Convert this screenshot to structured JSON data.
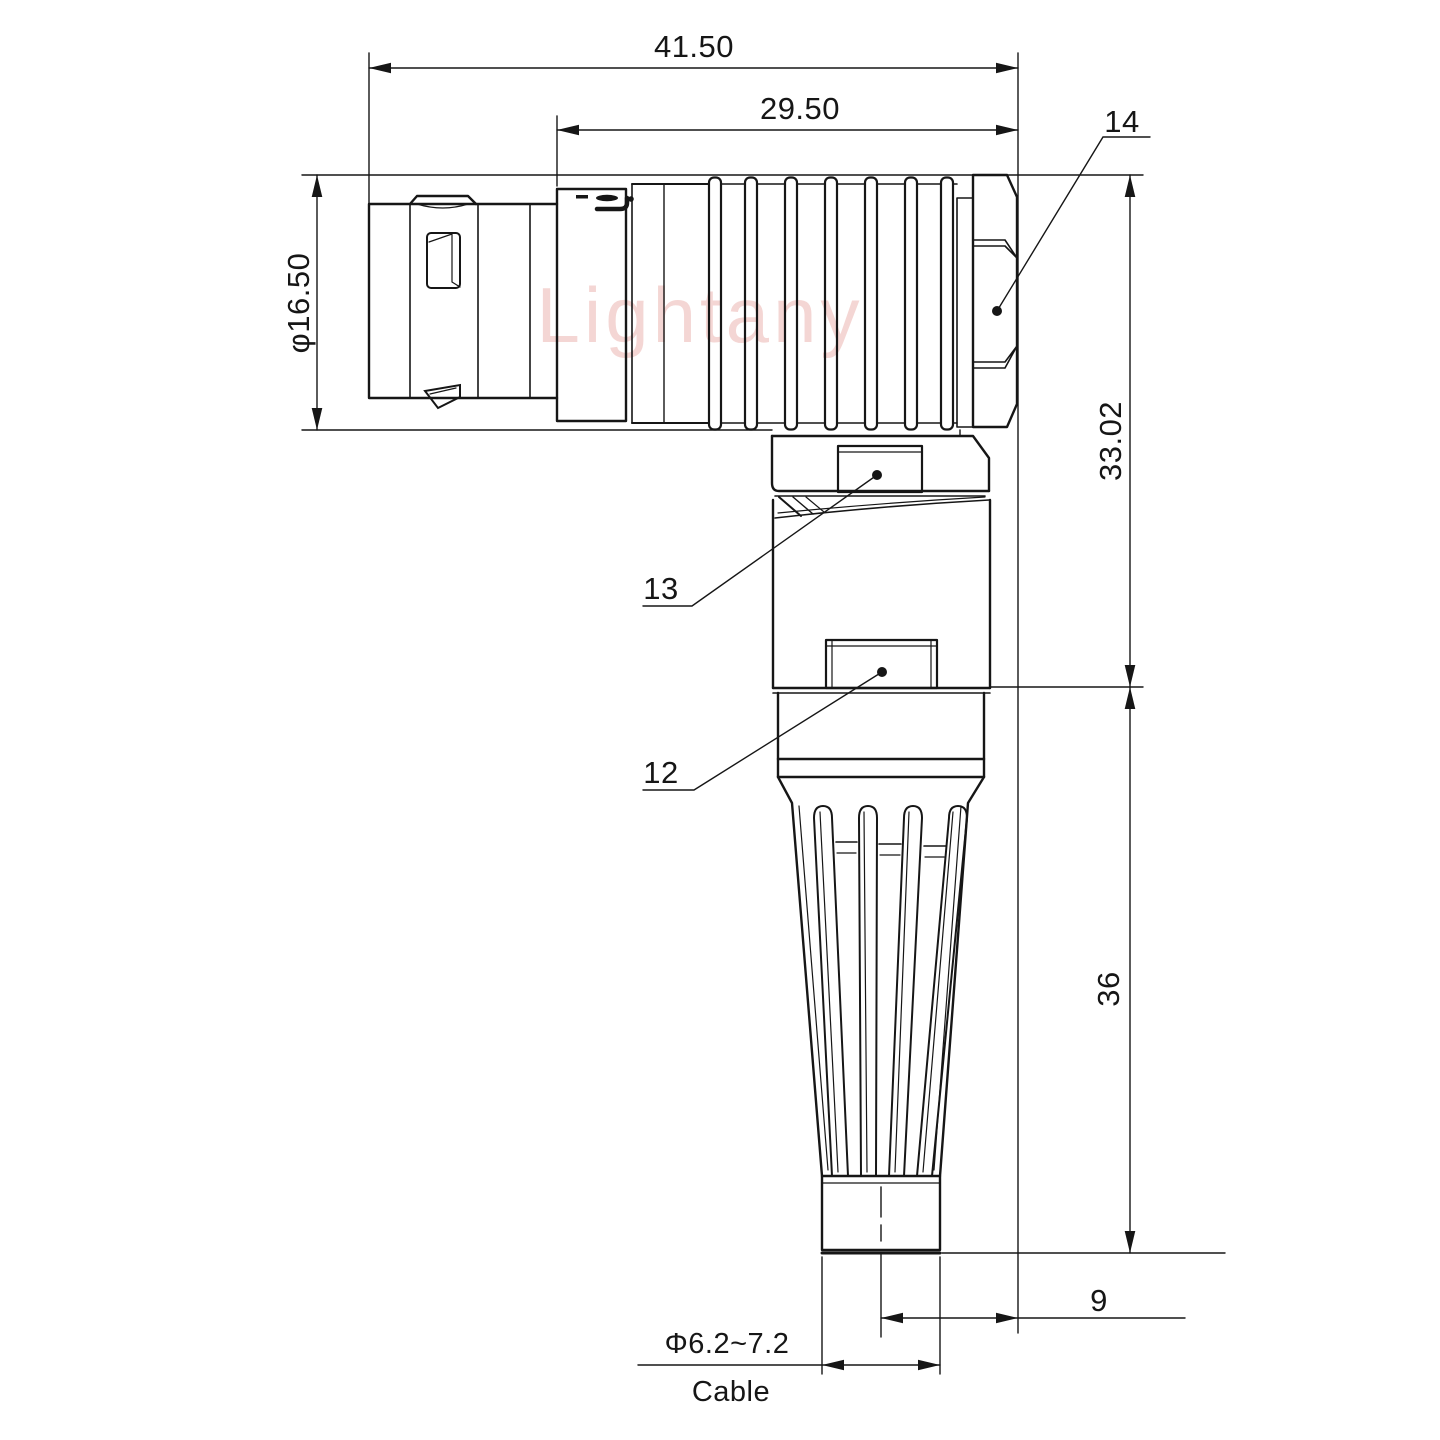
{
  "watermark": "Lightany",
  "colors": {
    "line": "#161616",
    "watermark": "#f2cdca",
    "background": "#ffffff"
  },
  "dims": {
    "overall_length": "41.50",
    "coupling_length": "29.50",
    "shell_diameter": "φ16.50",
    "elbow_height": "33.02",
    "boot_length": "36",
    "cable_offset": "9",
    "cable_diameter": "Φ6.2~7.2"
  },
  "labels": {
    "part14": "14",
    "part13": "13",
    "part12": "12",
    "cable": "Cable"
  }
}
